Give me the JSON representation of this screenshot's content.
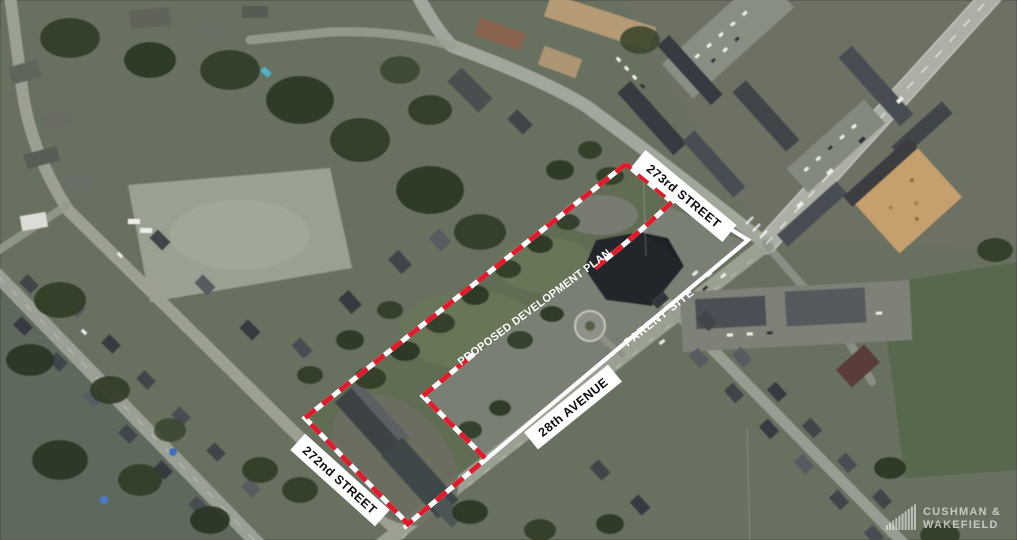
{
  "map": {
    "labels": {
      "street_273": "273rd STREET",
      "avenue_28": "28th AVENUE",
      "street_272": "272nd STREET",
      "proposed_plan": "PROPOSED DEVELOPMENT PLAN",
      "parent_site": "PARENT SITE"
    },
    "colors": {
      "boundary_red": "#e11b2c",
      "boundary_white": "#ffffff",
      "label_background": "#ffffff",
      "label_text": "#0d0d0d",
      "annotation_text": "#ffffff"
    }
  },
  "logo": {
    "line1": "CUSHMAN &",
    "line2": "WAKEFIELD"
  }
}
